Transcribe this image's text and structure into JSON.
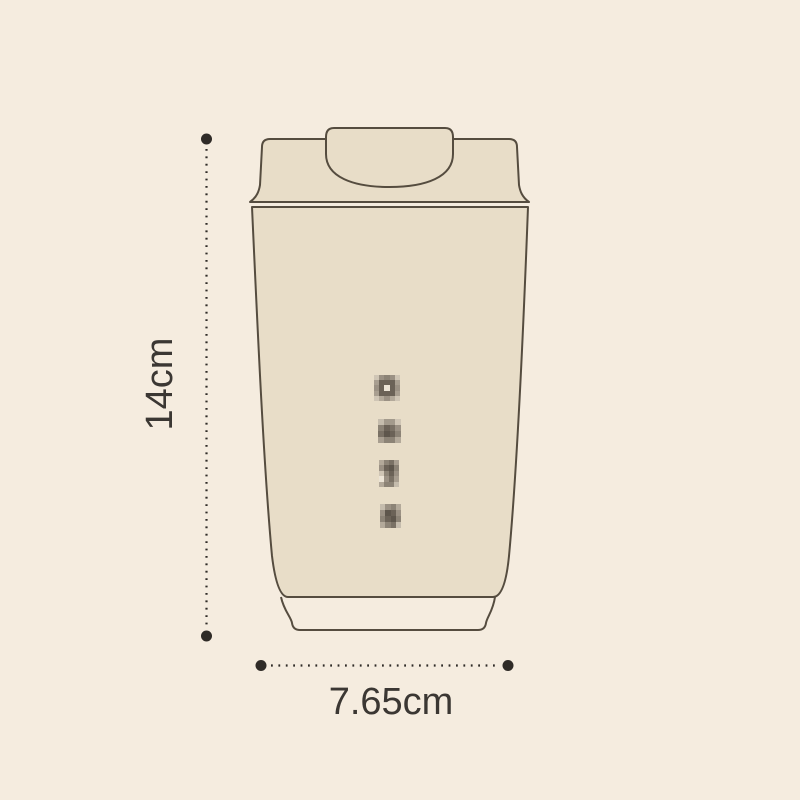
{
  "page": {
    "background_color": "#f5ecdf"
  },
  "diagram": {
    "subject": "tumbler-cup-outline-drawing",
    "colors": {
      "cup_fill": "#e8ddc8",
      "cup_outline": "#554c3f",
      "dimension_line": "#2f2b27",
      "label_text": "#3b3733"
    },
    "height_label": "14cm",
    "width_label": "7.65cm",
    "censored_marks": [
      {
        "x": 374,
        "y": 375,
        "w": 26,
        "h": 26,
        "pixels": [
          [
            "#cfc5b5",
            "#9b9184",
            "#8c8376",
            "#9b9184",
            "#cfc5b5"
          ],
          [
            "#a89e90",
            "#6b6257",
            "#6b6257",
            "#6b6257",
            "#a89e90"
          ],
          [
            "#9b9184",
            "#6b6257",
            "#ece4d6",
            "#6b6257",
            "#9b9184"
          ],
          [
            "#a89e90",
            "#6b6257",
            "#6b6257",
            "#6b6257",
            "#a89e90"
          ],
          [
            "#cfc5b5",
            "#b3a99a",
            "#9b9184",
            "#b3a99a",
            "#cfc5b5"
          ]
        ]
      },
      {
        "x": 378,
        "y": 419,
        "w": 23,
        "h": 24,
        "pixels": [
          [
            "#c5bcad",
            "#a39a8c",
            "#a39a8c",
            "#cfc5b5"
          ],
          [
            "#8c8376",
            "#6b6257",
            "#7a7165",
            "#9b9184"
          ],
          [
            "#7a7165",
            "#5e564c",
            "#6b6257",
            "#8c8376"
          ],
          [
            "#a89e90",
            "#8c8376",
            "#8c8376",
            "#b3a99a"
          ]
        ]
      },
      {
        "x": 379,
        "y": 460,
        "w": 20,
        "h": 27,
        "pixels": [
          [
            "#b3a99a",
            "#8c8376",
            "#7a7165",
            "#a89e90"
          ],
          [
            "#9b9184",
            "#6b6257",
            "#5e564c",
            "#8c8376"
          ],
          [
            "#cfc5b5",
            "#8c8376",
            "#6b6257",
            "#9b9184"
          ],
          [
            "#ece4d6",
            "#9b9184",
            "#7a7165",
            "#a89e90"
          ],
          [
            "#b3a99a",
            "#8c8376",
            "#8c8376",
            "#c5bcad"
          ]
        ]
      },
      {
        "x": 380,
        "y": 504,
        "w": 21,
        "h": 24,
        "pixels": [
          [
            "#c5bcad",
            "#9b9184",
            "#8c8376",
            "#b3a99a"
          ],
          [
            "#9b9184",
            "#5e564c",
            "#6b6257",
            "#9b9184"
          ],
          [
            "#8c8376",
            "#6b6257",
            "#5e564c",
            "#8c8376"
          ],
          [
            "#b3a99a",
            "#8c8376",
            "#7a7165",
            "#c5bcad"
          ]
        ]
      }
    ]
  }
}
